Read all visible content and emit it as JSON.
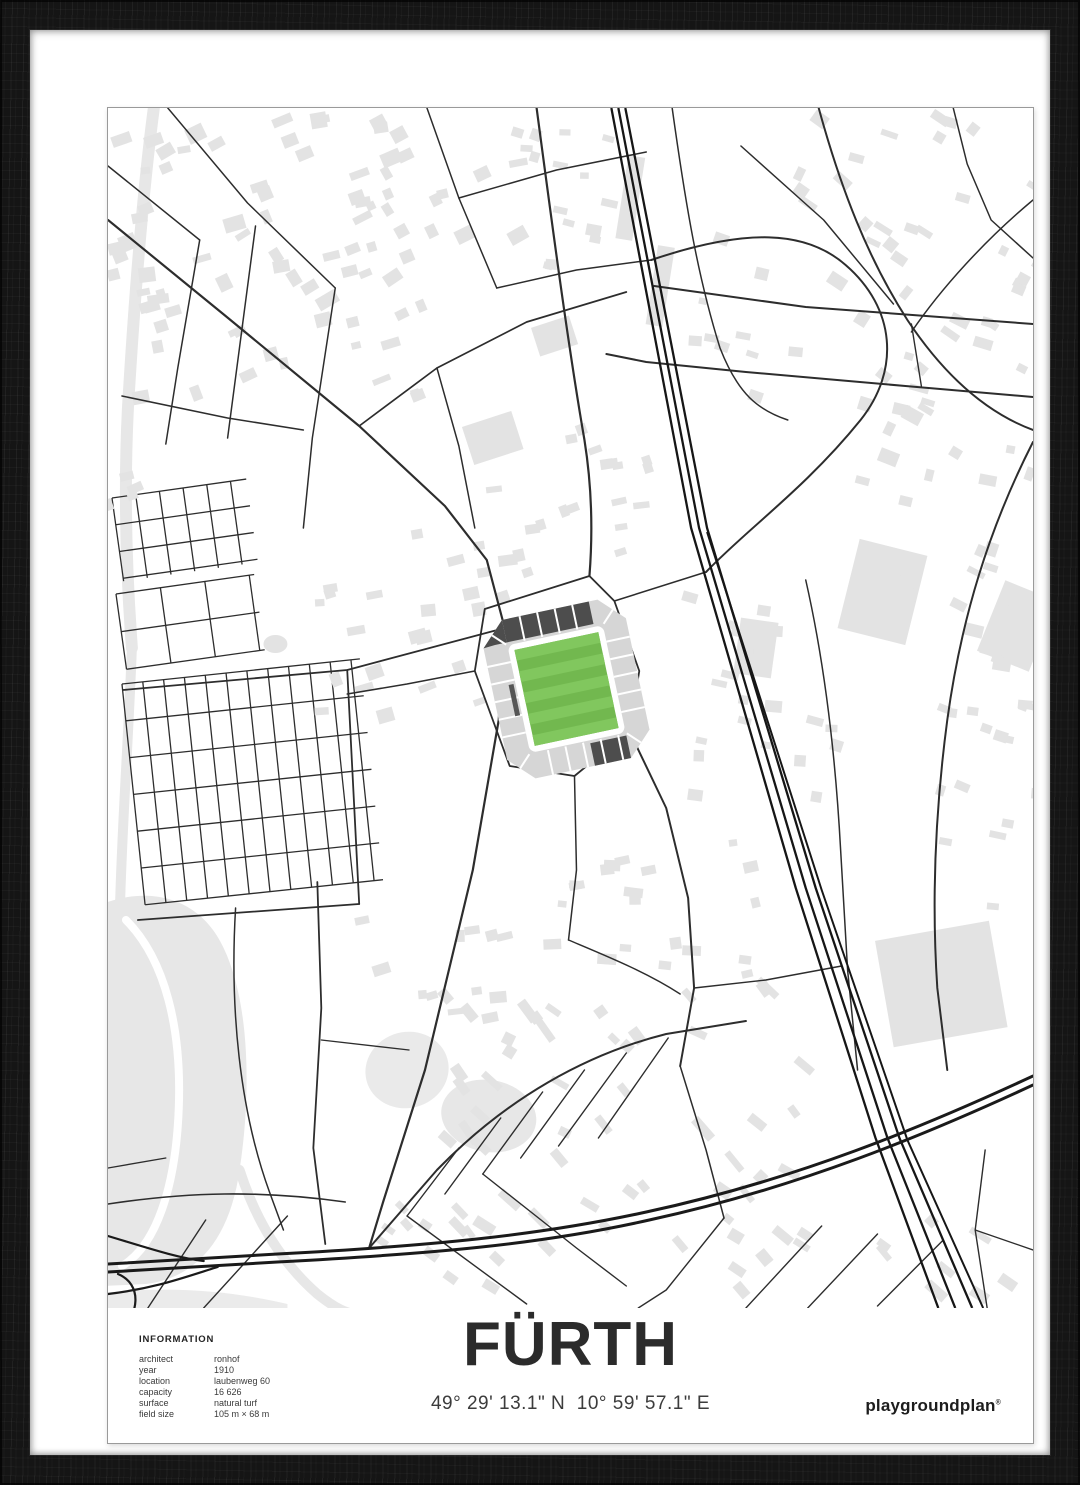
{
  "poster": {
    "title": "FÜRTH",
    "coordinates": "49° 29' 13.1\" N  10° 59' 57.1\" E",
    "brand": "playgroundplan",
    "brand_reg": "®",
    "info": {
      "heading": "INFORMATION",
      "rows": [
        {
          "label": "architect",
          "value": "ronhof"
        },
        {
          "label": "year",
          "value": "1910"
        },
        {
          "label": "location",
          "value": "laubenweg 60"
        },
        {
          "label": "capacity",
          "value": "16 626"
        },
        {
          "label": "surface",
          "value": "natural turf"
        },
        {
          "label": "field size",
          "value": "105 m × 68 m"
        }
      ]
    }
  },
  "colors": {
    "frame": "#151515",
    "mat": "#ffffff",
    "paper": "#ffffff",
    "street": "#2d2d2d",
    "rail": "#161616",
    "motorway": "#1a1a1a",
    "building": "#e3e3e3",
    "water": "#e7e7e7",
    "pitch_base": "#72b84f",
    "pitch_stripe": "#81c75e",
    "stand_light": "#d6d6d6",
    "stand_dark": "#4d4d4d"
  },
  "map": {
    "width": 928,
    "height": 1200,
    "street_color": "#2d2d2d",
    "rail_color": "#161616",
    "motorway_color": "#1a1a1a",
    "building_color": "#e3e3e3",
    "areas": [
      {
        "d": "M-6,796 C40,778 92,788 116,840 C142,894 144,984 132,1062 C122,1132 88,1170 38,1176 L-6,1178 Z",
        "f": "#e7e7e7",
        "n": "park-area"
      },
      {
        "d": "M-6,1185 C60,1178 120,1182 180,1196 L180,1200 L-6,1200 Z",
        "f": "#ebebeb",
        "n": "park-area"
      }
    ],
    "ellipses": [
      [
        300,
        962,
        42,
        38,
        "#eaeaea",
        -15
      ],
      [
        382,
        1008,
        48,
        36,
        "#e7e7e7",
        10
      ],
      [
        168,
        536,
        12,
        9,
        "#e3e3e3",
        0
      ]
    ],
    "area_strokes": [
      {
        "d": "M46,0 C34,90 26,200 20,300 C16,380 18,460 24,540",
        "w": 12,
        "c": "#e7e7e7",
        "n": "river"
      },
      {
        "d": "M24,540 C20,640 14,720 12,800",
        "w": 10,
        "c": "#e7e7e7",
        "n": "river"
      },
      {
        "d": "M132,1062 C150,1118 178,1158 210,1186 C230,1202 240,1205 250,1207",
        "w": 10,
        "c": "#e7e7e7",
        "n": "river"
      },
      {
        "d": "M18,812 C58,852 74,922 71,1000 C68,1080 48,1138 14,1158",
        "w": 8,
        "c": "#ffffff",
        "n": "park-path"
      }
    ],
    "grids": [
      {
        "x": 14,
        "y": 576,
        "w": 240,
        "h": 222,
        "rot": -6,
        "sx": 21,
        "sy": 37
      },
      {
        "x": 4,
        "y": 390,
        "w": 136,
        "h": 84,
        "rot": -8,
        "sx": 24,
        "sy": 27
      },
      {
        "x": 8,
        "y": 486,
        "w": 140,
        "h": 76,
        "rot": -8,
        "sx": 45,
        "sy": 38
      }
    ],
    "buildings": [
      [
        836,
        876,
        116,
        108,
        -10
      ],
      [
        777,
        484,
        70,
        92,
        14
      ],
      [
        912,
        518,
        56,
        76,
        22
      ],
      [
        524,
        90,
        17,
        84,
        9
      ],
      [
        554,
        178,
        17,
        80,
        9
      ],
      [
        386,
        330,
        52,
        40,
        -18
      ],
      [
        448,
        228,
        40,
        30,
        -18
      ],
      [
        650,
        540,
        38,
        56,
        8
      ]
    ],
    "clusters": [
      [
        170,
        150,
        165,
        140,
        48,
        8,
        22,
        6,
        16,
        -20,
        11,
        14
      ],
      [
        330,
        120,
        90,
        110,
        26,
        8,
        20,
        6,
        14,
        -20,
        12,
        12
      ],
      [
        470,
        90,
        60,
        80,
        16,
        8,
        18,
        6,
        12,
        10,
        13,
        10
      ],
      [
        820,
        140,
        130,
        130,
        40,
        8,
        20,
        6,
        14,
        28,
        14,
        14
      ],
      [
        850,
        420,
        95,
        140,
        30,
        8,
        20,
        6,
        14,
        20,
        15,
        12
      ],
      [
        320,
        520,
        110,
        95,
        26,
        8,
        20,
        6,
        14,
        -12,
        16,
        10
      ],
      [
        455,
        385,
        95,
        70,
        18,
        8,
        18,
        6,
        12,
        -12,
        17,
        10
      ],
      [
        655,
        590,
        80,
        110,
        20,
        8,
        18,
        6,
        12,
        8,
        18,
        10
      ],
      [
        520,
        1010,
        190,
        130,
        50,
        10,
        26,
        6,
        12,
        40,
        19,
        16
      ],
      [
        770,
        1180,
        140,
        80,
        22,
        10,
        24,
        6,
        12,
        40,
        20,
        12
      ],
      [
        545,
        800,
        120,
        70,
        20,
        8,
        20,
        6,
        12,
        0,
        21,
        14
      ],
      [
        890,
        700,
        55,
        130,
        16,
        8,
        18,
        6,
        12,
        15,
        22,
        10
      ],
      [
        320,
        860,
        80,
        55,
        12,
        8,
        18,
        6,
        12,
        -8,
        23,
        10
      ],
      [
        40,
        240,
        45,
        160,
        14,
        8,
        16,
        6,
        12,
        -20,
        24,
        10
      ],
      [
        330,
        1140,
        70,
        45,
        10,
        8,
        18,
        6,
        10,
        40,
        25,
        10
      ],
      [
        645,
        205,
        60,
        85,
        10,
        8,
        16,
        6,
        12,
        12,
        26,
        10
      ]
    ],
    "streets": [
      [
        "M0,112 L118,208 L252,318 L338,398 L380,452 L398,520",
        2.2
      ],
      [
        "M398,520 L392,612 L366,762 L318,962 L276,1094 L262,1140",
        2.2
      ],
      [
        "M0,58 L92,132",
        1.5
      ],
      [
        "M60,0 L140,95 L228,180",
        1.5
      ],
      [
        "M148,118 L120,330",
        1.5
      ],
      [
        "M228,180 L205,330 L196,420",
        1.5
      ],
      [
        "M92,132 L70,260 L58,336",
        1.5
      ],
      [
        "M14,288 L120,310 L196,322",
        1.5
      ],
      [
        "M252,318 L330,260 L420,214 L520,184",
        1.7
      ],
      [
        "M330,260 L352,338 L368,420",
        1.5
      ],
      [
        "M430,0 C446,120 462,240 478,332 C486,382 486,430 483,468",
        2.2
      ],
      [
        "M320,0 L352,90 L390,180",
        1.5
      ],
      [
        "M352,90 L450,62 L540,44",
        1.5
      ],
      [
        "M390,180 L470,162 L545,152",
        1.5
      ],
      [
        "M545,152 C640,120 700,122 740,157 C790,200 795,262 755,312 C700,380 640,422 600,464",
        2.0
      ],
      [
        "M600,464 L508,493",
        1.5
      ],
      [
        "M566,0 C580,100 592,170 614,240 C632,286 652,302 682,312",
        1.5
      ],
      [
        "M548,178 L700,199 L928,216",
        2.0
      ],
      [
        "M500,246 L540,254 L640,264 L800,278 L928,289",
        2.0
      ],
      [
        "M806,216 L816,278",
        1.4
      ],
      [
        "M713,0 C735,80 762,150 802,212 C842,272 885,306 928,322",
        2.0
      ],
      [
        "M635,38 L718,112 L788,196",
        1.5
      ],
      [
        "M928,92 C880,132 836,180 806,224",
        1.5
      ],
      [
        "M848,0 L862,56 L886,112 L928,150",
        1.5
      ],
      [
        "M928,334 C884,420 856,510 842,612 C830,702 826,790 832,880 L842,962",
        2.0
      ],
      [
        "M700,472 C720,560 730,650 735,742 L742,862 L752,962",
        1.5
      ],
      [
        "M378,501 L483,468 L508,493 L533,563 L523,623 L468,668 L403,658 L368,563 Z",
        1.8
      ],
      [
        "M368,563 L300,576 L240,586",
        1.5
      ],
      [
        "M468,668 L470,762 L462,832",
        1.5
      ],
      [
        "M523,623 L560,700 L582,790 L588,880 L574,958",
        2.0
      ],
      [
        "M462,832 C500,848 540,864 574,886",
        1.4
      ],
      [
        "M262,1140 L330,1062 C400,990 480,946 560,926 L640,913",
        2.0
      ],
      [
        "M352,1040 L300,1108",
        1.4
      ],
      [
        "M394,1010 L338,1086",
        1.4
      ],
      [
        "M436,984 L376,1066",
        1.4
      ],
      [
        "M478,962 L414,1050",
        1.4
      ],
      [
        "M520,945 L452,1038",
        1.4
      ],
      [
        "M562,930 L492,1030",
        1.4
      ],
      [
        "M300,1108 L420,1196",
        1.4
      ],
      [
        "M376,1066 L470,1140 L520,1178",
        1.4
      ],
      [
        "M210,774 L214,900 L206,1040 L218,1136",
        1.8
      ],
      [
        "M128,800 C122,900 132,1002 162,1084 L176,1122",
        1.5
      ],
      [
        "M214,932 L302,942",
        1.3
      ],
      [
        "M15,582 L240,562 L398,520",
        1.8
      ],
      [
        "M240,562 L252,796",
        1.8
      ],
      [
        "M30,812 L252,796",
        1.8
      ],
      [
        "M588,880 L660,872 L736,858",
        1.4
      ],
      [
        "M574,958 L600,1042 L618,1110",
        1.5
      ],
      [
        "M618,1110 L560,1182 L532,1200",
        1.4
      ],
      [
        "M640,1200 L716,1118",
        1.4
      ],
      [
        "M702,1200 L772,1126",
        1.4
      ],
      [
        "M772,1198 L838,1132",
        1.4
      ],
      [
        "M880,1042 L870,1122 L882,1200",
        1.4
      ],
      [
        "M870,1122 L928,1142",
        1.3
      ],
      [
        "M0,1096 C80,1084 152,1082 238,1094",
        1.6
      ],
      [
        "M96,1200 L180,1108",
        1.4
      ],
      [
        "M40,1200 L98,1112",
        1.4
      ],
      [
        "M0,1060 L58,1050",
        1.3
      ]
    ],
    "rails": [
      [
        "M505,0 L585,420 L690,780 L770,1030 L833,1200",
        2.3
      ],
      [
        "M512,0 L593,420 L700,780 L782,1030 L850,1200",
        2.3
      ],
      [
        "M519,0 L601,420 L710,780 L794,1030 L867,1200",
        2.3
      ],
      [
        "M601,424 L716,782 L802,1032 L878,1200",
        2.0
      ]
    ],
    "motorways": [
      [
        "M0,1156 L170,1146 C320,1138 430,1128 540,1104 C690,1072 820,1018 928,968",
        3
      ],
      [
        "M0,1164 L170,1154 C320,1146 432,1137 543,1112 C692,1080 822,1026 928,977",
        3
      ],
      [
        "M0,1128 C40,1140 70,1150 96,1153",
        2.2
      ],
      [
        "M0,1186 C50,1180 80,1168 110,1159",
        2.2
      ],
      [
        "M6,1232 C34,1206 34,1176 10,1166",
        2.2
      ]
    ],
    "stadium": {
      "cx": 460,
      "cy": 581,
      "rot": -12,
      "shapes": [
        {
          "t": "p",
          "d": "M-73,-57 L-49,-81 L49,-81 L73,-57 L73,57 L49,81 L-49,81 L-73,57 Z",
          "f": "#d6d6d6"
        },
        {
          "t": "r",
          "x": -49,
          "y": -55,
          "w": 98,
          "h": 110,
          "rx": 7,
          "f": "#ffffff"
        },
        {
          "t": "r",
          "x": -49,
          "y": -81,
          "w": 89,
          "h": 23,
          "f": "#4d4d4d"
        },
        {
          "t": "p",
          "d": "M-73,-57 L-49,-81 L-49,-58 L-61,-58 Z",
          "f": "#4d4d4d"
        },
        {
          "t": "r",
          "x": 12,
          "y": 58,
          "w": 37,
          "h": 23,
          "f": "#4d4d4d"
        },
        {
          "t": "pitch",
          "x": -43,
          "y": -49,
          "w": 86,
          "h": 98,
          "n": 9,
          "base": "#72b84f",
          "stripe": "#81c75e"
        },
        {
          "t": "l",
          "x1": -31,
          "y1": -81,
          "x2": -31,
          "y2": -56
        },
        {
          "t": "l",
          "x1": -13,
          "y1": -81,
          "x2": -13,
          "y2": -56
        },
        {
          "t": "l",
          "x1": 5,
          "y1": -81,
          "x2": 5,
          "y2": -56
        },
        {
          "t": "l",
          "x1": 23,
          "y1": -81,
          "x2": 23,
          "y2": -56
        },
        {
          "t": "l",
          "x1": -31,
          "y1": 56,
          "x2": -31,
          "y2": 81
        },
        {
          "t": "l",
          "x1": -13,
          "y1": 56,
          "x2": -13,
          "y2": 81
        },
        {
          "t": "l",
          "x1": 5,
          "y1": 56,
          "x2": 5,
          "y2": 81
        },
        {
          "t": "l",
          "x1": 23,
          "y1": 56,
          "x2": 23,
          "y2": 81
        },
        {
          "t": "l",
          "x1": 41,
          "y1": 56,
          "x2": 41,
          "y2": 81
        },
        {
          "t": "l",
          "x1": -73,
          "y1": -38,
          "x2": -49,
          "y2": -38
        },
        {
          "t": "l",
          "x1": -73,
          "y1": -20,
          "x2": -49,
          "y2": -20
        },
        {
          "t": "l",
          "x1": -73,
          "y1": -2,
          "x2": -49,
          "y2": -2
        },
        {
          "t": "l",
          "x1": -73,
          "y1": 16,
          "x2": -49,
          "y2": 16
        },
        {
          "t": "l",
          "x1": -73,
          "y1": 34,
          "x2": -49,
          "y2": 34
        },
        {
          "t": "l",
          "x1": 49,
          "y1": -38,
          "x2": 73,
          "y2": -38
        },
        {
          "t": "l",
          "x1": 49,
          "y1": -20,
          "x2": 73,
          "y2": -20
        },
        {
          "t": "l",
          "x1": 49,
          "y1": -2,
          "x2": 73,
          "y2": -2
        },
        {
          "t": "l",
          "x1": 49,
          "y1": 16,
          "x2": 73,
          "y2": 16
        },
        {
          "t": "l",
          "x1": 49,
          "y1": 34,
          "x2": 73,
          "y2": 34
        },
        {
          "t": "l",
          "x1": -62,
          "y1": -68,
          "x2": -50,
          "y2": -56
        },
        {
          "t": "l",
          "x1": 50,
          "y1": -56,
          "x2": 62,
          "y2": -68
        },
        {
          "t": "l",
          "x1": 50,
          "y1": 56,
          "x2": 62,
          "y2": 68
        },
        {
          "t": "l",
          "x1": -62,
          "y1": 68,
          "x2": -50,
          "y2": 56
        },
        {
          "t": "r",
          "x": -56,
          "y": -16,
          "w": 5,
          "h": 32,
          "f": "#565656"
        }
      ]
    }
  }
}
